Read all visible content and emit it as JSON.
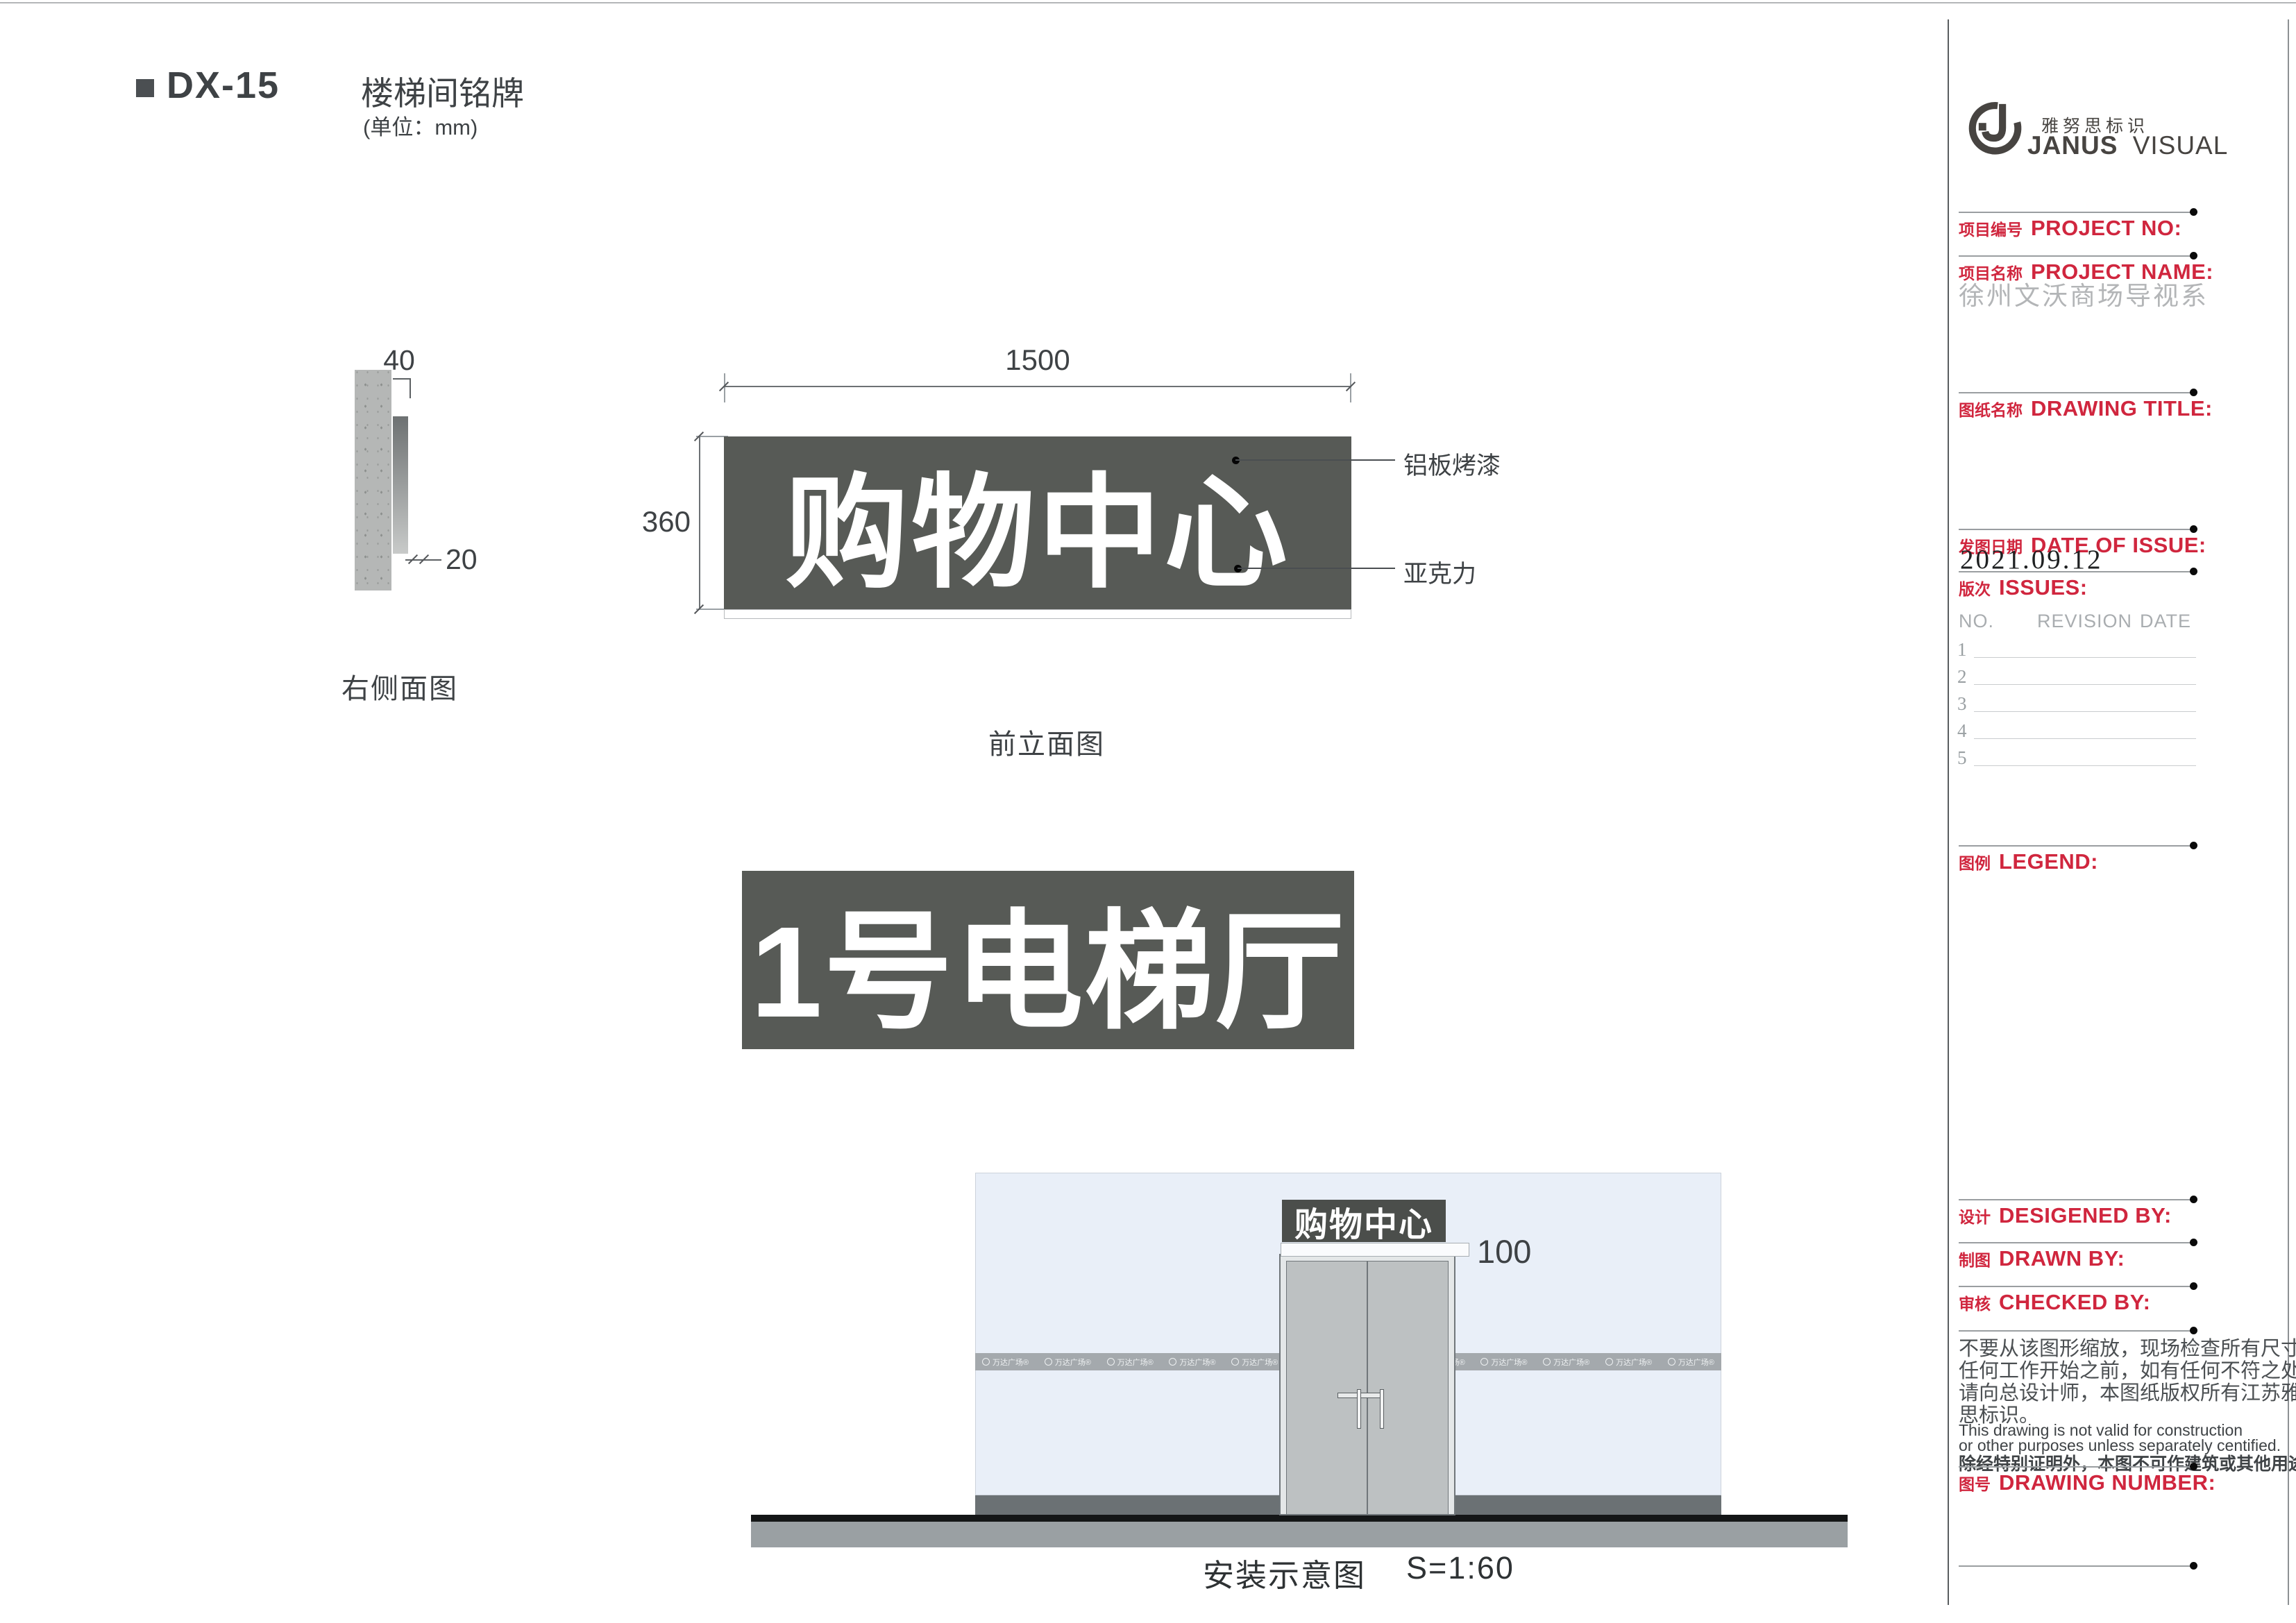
{
  "header": {
    "code": "DX-15",
    "title": "楼梯间铭牌",
    "unit": "(单位：mm)"
  },
  "side_view": {
    "label": "右侧面图",
    "dim_top": "40",
    "dim_gap": "20"
  },
  "front_view": {
    "label": "前立面图",
    "dim_width": "1500",
    "dim_height": "360",
    "sign_text": "购物中心",
    "callout_top": "铝板烤漆",
    "callout_bottom": "亚克力"
  },
  "sign2": {
    "text": "1号电梯厅"
  },
  "install": {
    "sign_text": "购物中心",
    "dim": "100",
    "caption": "安装示意图",
    "scale": "S=1:60",
    "band_logo": "万达广场®"
  },
  "titleblock": {
    "brand_cn": "雅努思标识",
    "brand_en_bold": "JANUS",
    "brand_en_light": "VISUAL",
    "project_no": {
      "cn": "项目编号",
      "en": "PROJECT NO:"
    },
    "project_name": {
      "cn": "项目名称",
      "en": "PROJECT NAME:",
      "value": "徐州文沃商场导视系"
    },
    "drawing_title": {
      "cn": "图纸名称",
      "en": "DRAWING TITLE:"
    },
    "date_of_issue": {
      "cn": "发图日期",
      "en": "DATE OF ISSUE:",
      "value": "2021.09.12"
    },
    "issues": {
      "cn": "版次",
      "en": "ISSUES:",
      "headers": [
        "NO.",
        "REVISION",
        "DATE"
      ],
      "rows": [
        "1",
        "2",
        "3",
        "4",
        "5"
      ]
    },
    "legend": {
      "cn": "图例",
      "en": "LEGEND:"
    },
    "designed_by": {
      "cn": "设计",
      "en": "DESIGENED BY:"
    },
    "drawn_by": {
      "cn": "制图",
      "en": "DRAWN BY:"
    },
    "checked_by": {
      "cn": "审核",
      "en": "CHECKED BY:"
    },
    "drawing_number": {
      "cn": "图号",
      "en": "DRAWING NUMBER:"
    },
    "disclaimer_cn": [
      "不要从该图形缩放，现场检查所有尺寸在",
      "任何工作开始之前，如有任何不符之处，",
      "请向总设计师，本图纸版权所有江苏雅努",
      "思标识。"
    ],
    "disclaimer_en": [
      "This drawing is not valid for construction",
      "or other purposes unless separately centified."
    ],
    "disclaimer_cn2": "除经特别证明外，本图不可作建筑或其他用途。"
  },
  "colors": {
    "accent_red": "#d0263e",
    "sign_dark": "#575a56",
    "wall_blue": "#e9eff8"
  }
}
